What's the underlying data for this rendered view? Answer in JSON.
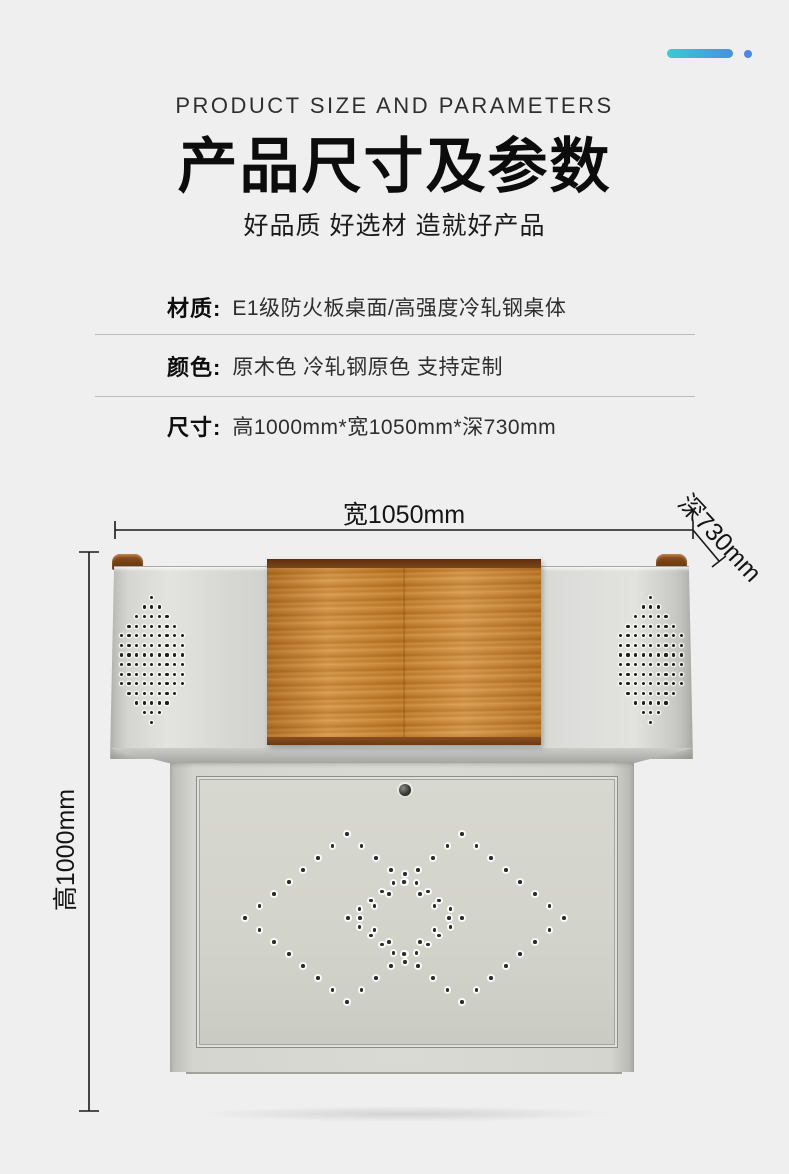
{
  "header": {
    "eyebrow": "PRODUCT SIZE AND PARAMETERS",
    "title": "产品尺寸及参数",
    "subtitle": "好品质 好选材 造就好产品"
  },
  "specs": [
    {
      "label": "材质:",
      "value": "E1级防火板桌面/高强度冷轧钢桌体"
    },
    {
      "label": "颜色:",
      "value": "原木色 冷轧钢原色  支持定制"
    },
    {
      "label": "尺寸:",
      "value": "高1000mm*宽1050mm*深730mm"
    }
  ],
  "dims": {
    "width": "宽1050mm",
    "depth": "深730mm",
    "height": "高1000mm"
  },
  "colors": {
    "background": "#efefef",
    "accent_gradient_start": "#3ec9d2",
    "accent_gradient_end": "#4a8fe2",
    "accent_dot": "#4a87e8",
    "dimension_line": "#1a1a1a",
    "metal_body": "#d7d7d3",
    "wood": "#c07c2a",
    "wood_edge_dark": "#6b3a13"
  }
}
